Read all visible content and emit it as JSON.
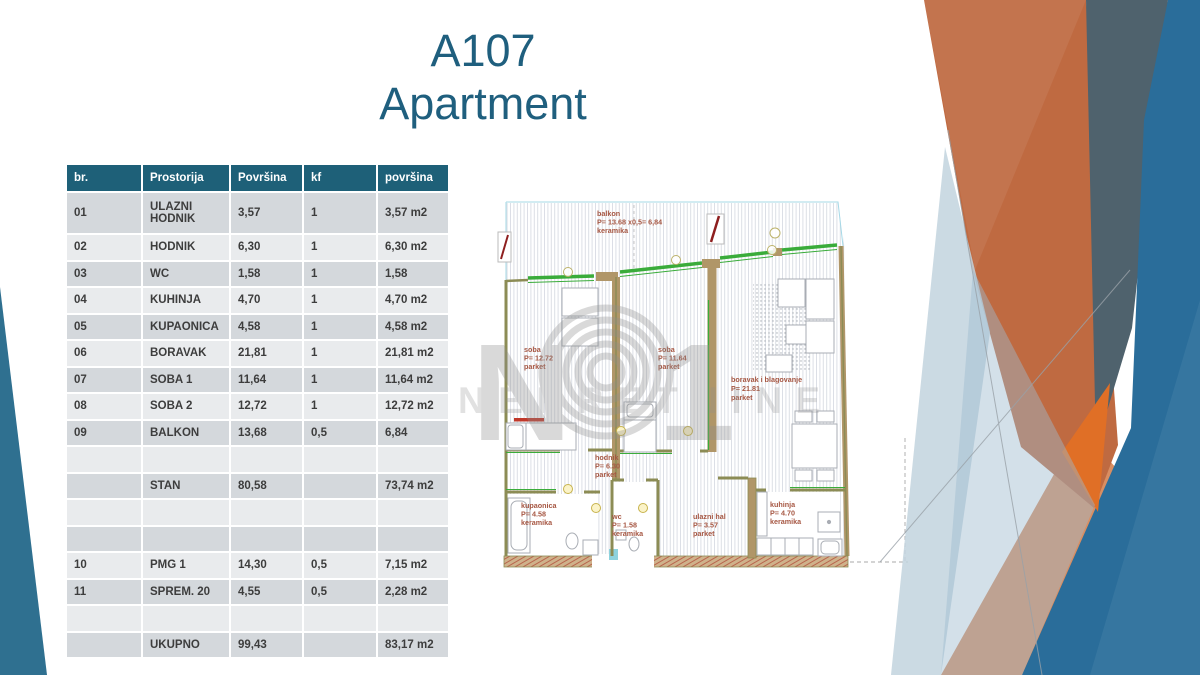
{
  "slide": {
    "title_line1": "A107",
    "title_line2": "Apartment"
  },
  "table": {
    "headers": [
      "br.",
      "Prostorija",
      "Površina",
      "kf",
      "površina"
    ],
    "rows": [
      [
        "01",
        "ULAZNI HODNIK",
        "3,57",
        "1",
        "3,57 m2"
      ],
      [
        "02",
        "HODNIK",
        "6,30",
        "1",
        "6,30 m2"
      ],
      [
        "03",
        "WC",
        "1,58",
        "1",
        "1,58"
      ],
      [
        "04",
        "KUHINJA",
        "4,70",
        "1",
        "4,70 m2"
      ],
      [
        "05",
        "KUPAONICA",
        "4,58",
        "1",
        "4,58 m2"
      ],
      [
        "06",
        "BORAVAK",
        "21,81",
        "1",
        "21,81 m2"
      ],
      [
        "07",
        "SOBA 1",
        "11,64",
        "1",
        "11,64 m2"
      ],
      [
        "08",
        "SOBA 2",
        "12,72",
        "1",
        "12,72 m2"
      ],
      [
        "09",
        "BALKON",
        "13,68",
        "0,5",
        "6,84"
      ],
      [
        "",
        "",
        "",
        "",
        ""
      ],
      [
        "",
        "STAN",
        "80,58",
        "",
        "73,74 m2"
      ],
      [
        "",
        "",
        "",
        "",
        ""
      ],
      [
        "",
        "",
        "",
        "",
        ""
      ],
      [
        "10",
        "PMG 1",
        "14,30",
        "0,5",
        "7,15 m2"
      ],
      [
        "11",
        "SPREM. 20",
        "4,55",
        "0,5",
        "2,28 m2"
      ],
      [
        "",
        "",
        "",
        "",
        ""
      ],
      [
        "",
        "UKUPNO",
        "99,43",
        "",
        "83,17 m2"
      ]
    ]
  },
  "floorplan": {
    "watermark": {
      "letter_n": "N",
      "digit_one": "1",
      "brand_word": "NEKRETNINE"
    },
    "labels": {
      "balkon": [
        "balkon",
        "P= 13.68 x0,5= 6,84",
        "keramika"
      ],
      "soba1": [
        "soba",
        "P= 12.72",
        "parket"
      ],
      "soba2": [
        "soba",
        "P= 11.64",
        "parket"
      ],
      "boravak": [
        "boravak i blagovanje",
        "P= 21.81",
        "parket"
      ],
      "hodnik": [
        "hodnik",
        "P= 6.30",
        "parket"
      ],
      "kupaonica": [
        "kupaonica",
        "P= 4.58",
        "keramika"
      ],
      "wc": [
        "wc",
        "P= 1.58",
        "keramika"
      ],
      "ulazni_hal": [
        "ulazni hal",
        "P= 3.57",
        "parket"
      ],
      "kuhinja": [
        "kuhinja",
        "P= 4.70",
        "keramika"
      ]
    }
  },
  "colors": {
    "title_text": "#1F5F7E",
    "table_header_bg": "#1E6078",
    "row_dark": "#D4D8DC",
    "row_light": "#E9EBED",
    "left_wedge_teal": "#2F7090",
    "decor_orange": "#BF6A41",
    "decor_bright_orange": "#E06F26",
    "decor_salmon": "#D98E62",
    "decor_blue": "#2A6D9A",
    "decor_slate": "#4F626D",
    "decor_light_blue": "#C2D3DE",
    "plan_label_text": "#A65743",
    "plan_window_green": "#3AAC3A",
    "plan_wall_olive": "#8C8C55",
    "plan_wall_tan": "#B09668"
  }
}
